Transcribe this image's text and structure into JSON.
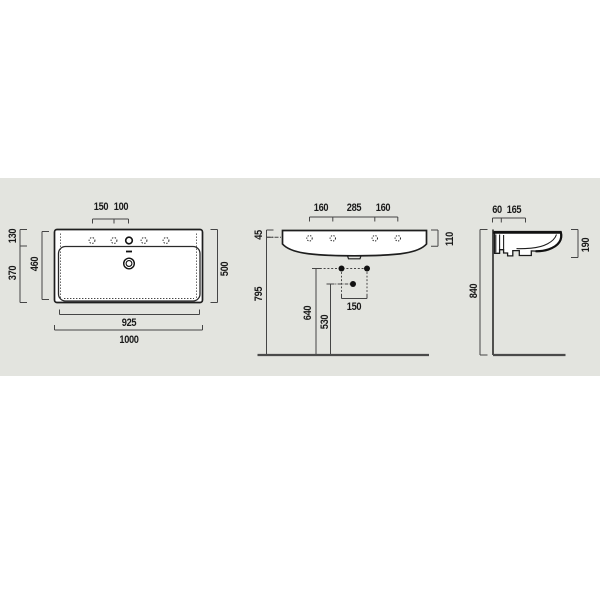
{
  "drawing": {
    "product": "wall-hung washbasin technical drawing",
    "views": {
      "top": {
        "dims": {
          "hole_spacing_outer": "150",
          "hole_spacing_inner": "100",
          "edge_to_holes": "130",
          "holes_to_front": "370",
          "bowl_depth": "460",
          "overall_depth": "500",
          "bowl_width": "925",
          "overall_width": "1000"
        }
      },
      "front": {
        "dims": {
          "hole_left": "160",
          "hole_center": "285",
          "hole_right": "160",
          "rim_thickness": "45",
          "rim_height": "110",
          "underside_height": "795",
          "fixing_height": "640",
          "drain_height": "530",
          "fixing_spacing": "150"
        }
      },
      "side": {
        "dims": {
          "wall_offset": "60",
          "bracket_depth": "165",
          "body_height": "190",
          "rim_height_floor": "840"
        }
      }
    },
    "colors": {
      "background": "#ffffff",
      "panel": "#e3e4df",
      "object_line": "#1e1e1e",
      "dimension_line": "#454545",
      "text": "#1a1a1a"
    }
  }
}
